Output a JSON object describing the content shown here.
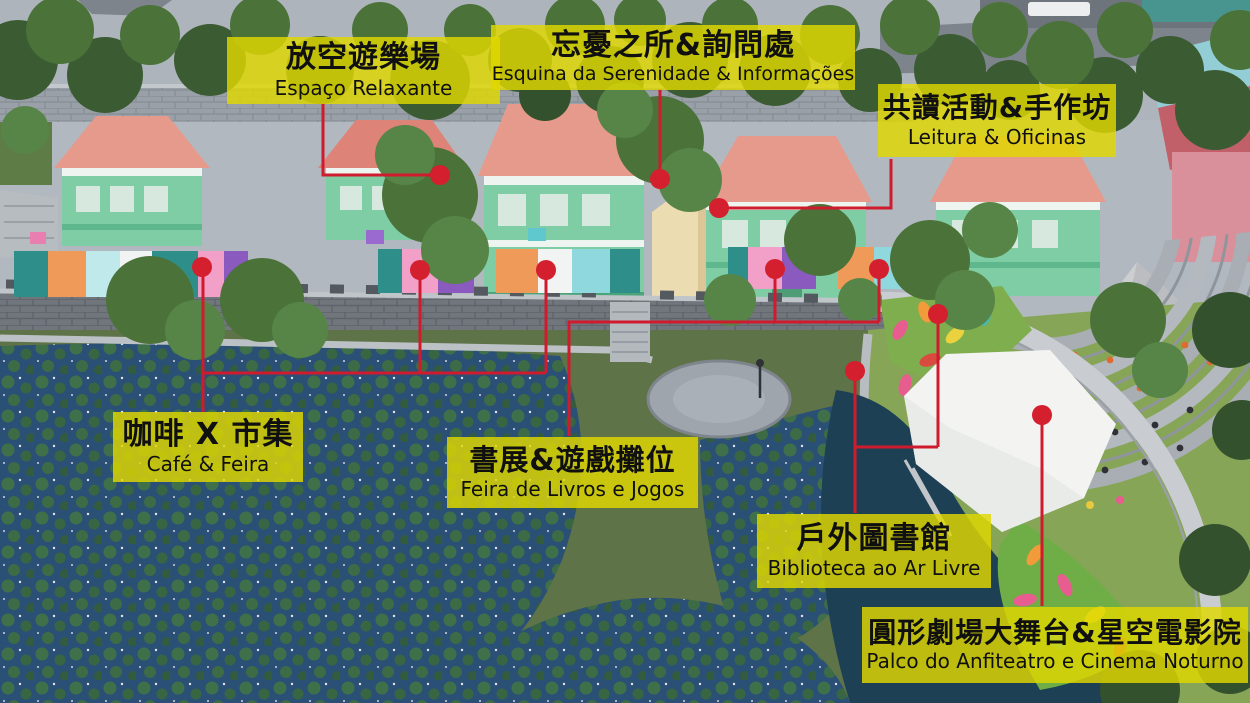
{
  "map": {
    "labels": [
      {
        "id": "espaco-relaxante",
        "zh": "放空遊樂場",
        "pt": "Espaço Relaxante"
      },
      {
        "id": "esquina-serenidade",
        "zh": "忘憂之所&詢問處",
        "pt": "Esquina da Serenidade & Informações"
      },
      {
        "id": "leitura-oficinas",
        "zh": "共讀活動&手作坊",
        "pt": "Leitura & Oficinas"
      },
      {
        "id": "cafe-feira",
        "zh": "咖啡 X 市集",
        "pt": "Café & Feira"
      },
      {
        "id": "feira-livros-jogos",
        "zh": "書展&遊戲攤位",
        "pt": "Feira de Livros e Jogos"
      },
      {
        "id": "biblioteca-ar-livre",
        "zh": "戶外圖書館",
        "pt": "Biblioteca ao Ar Livre"
      },
      {
        "id": "palco-anfiteatro",
        "zh": "圓形劇場大舞台&星空電影院",
        "pt": "Palco do Anfiteatro e Cinema Noturno"
      }
    ],
    "theme": {
      "label_background": "#e0d800",
      "label_text": "#111111",
      "marker_color": "#d41f2e",
      "connector_color": "#cf1b2d"
    }
  }
}
